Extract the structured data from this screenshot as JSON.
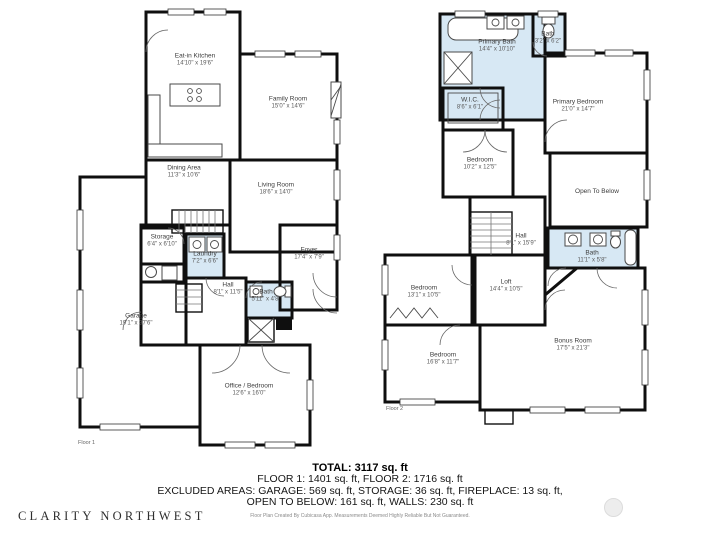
{
  "floor1": {
    "label": "Floor 1",
    "rooms": [
      {
        "name": "Eat-in Kitchen",
        "dims": "14'10\" x 19'6\""
      },
      {
        "name": "Family Room",
        "dims": "15'0\" x 14'6\""
      },
      {
        "name": "Dining Area",
        "dims": "11'3\" x 10'6\""
      },
      {
        "name": "Living Room",
        "dims": "18'6\" x 14'0\""
      },
      {
        "name": "Storage",
        "dims": "6'4\" x 6'10\""
      },
      {
        "name": "Laundry",
        "dims": "7'2\" x 6'6\""
      },
      {
        "name": "Hall",
        "dims": "8'1\" x 11'5\""
      },
      {
        "name": "Foyer",
        "dims": "17'4\" x 7'9\""
      },
      {
        "name": "Bath",
        "dims": "5'11\" x 4'8\""
      },
      {
        "name": "Garage",
        "dims": "19'1\" x 37'6\""
      },
      {
        "name": "Office / Bedroom",
        "dims": "12'6\" x 16'0\""
      }
    ]
  },
  "floor2": {
    "label": "Floor 2",
    "rooms": [
      {
        "name": "Primary Bath",
        "dims": "14'4\" x 10'10\""
      },
      {
        "name": "Bath",
        "dims": "3'2\" x 6'2\""
      },
      {
        "name": "Primary Bedroom",
        "dims": "21'0\" x 14'7\""
      },
      {
        "name": "W.I.C.",
        "dims": "8'6\" x 6'1\""
      },
      {
        "name": "Bedroom",
        "dims": "10'2\" x 12'5\""
      },
      {
        "name": "Open To Below",
        "dims": ""
      },
      {
        "name": "Hall",
        "dims": "8'1\" x 15'9\""
      },
      {
        "name": "Bath",
        "dims": "11'1\" x 5'8\""
      },
      {
        "name": "Bedroom",
        "dims": "13'1\" x 10'5\""
      },
      {
        "name": "Loft",
        "dims": "14'4\" x 10'5\""
      },
      {
        "name": "Bedroom",
        "dims": "16'8\" x 11'7\""
      },
      {
        "name": "Bonus Room",
        "dims": "17'5\" x 21'3\""
      }
    ]
  },
  "summary": {
    "total": "TOTAL: 3117 sq. ft",
    "line1": "FLOOR 1: 1401 sq. ft, FLOOR 2: 1716 sq. ft",
    "line2": "EXCLUDED AREAS: GARAGE: 569 sq. ft, STORAGE: 36 sq. ft, FIREPLACE: 13 sq. ft,",
    "line3": "OPEN TO BELOW: 161 sq. ft, WALLS: 230 sq. ft",
    "disclaimer": "Floor Plan Created By Cubicasa App. Measurements Deemed Highly Reliable But Not Guaranteed."
  },
  "branding": {
    "logo": "CLARITY NORTHWEST"
  }
}
